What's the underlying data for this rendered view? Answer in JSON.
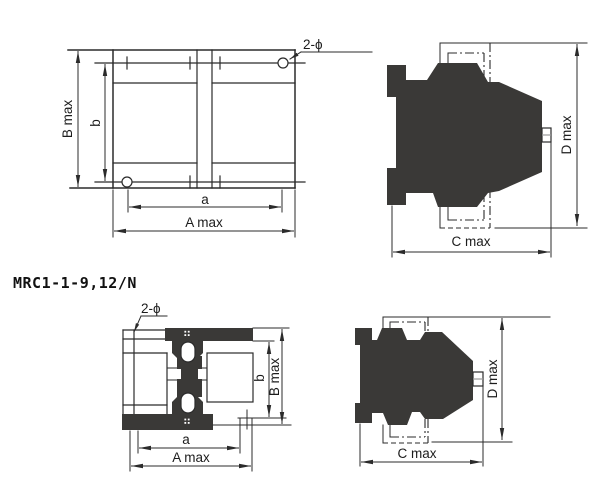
{
  "title": "MRC1-1-9,12/N",
  "colors": {
    "line": "#2b2b2b",
    "silhouette_fill": "#3a3937",
    "background": "#ffffff"
  },
  "views": {
    "front_top": {
      "labels": {
        "b_max": "B max",
        "b": "b",
        "a": "a",
        "a_max": "A max",
        "holes": "2-ϕ"
      }
    },
    "side_top": {
      "labels": {
        "c_max": "C max",
        "d_max": "D max"
      }
    },
    "front_bottom": {
      "labels": {
        "holes": "2-ϕ",
        "b": "b",
        "b_max": "B max",
        "a": "a",
        "a_max": "A max"
      }
    },
    "side_bottom": {
      "labels": {
        "c_max": "C max",
        "d_max": "D max"
      }
    }
  }
}
